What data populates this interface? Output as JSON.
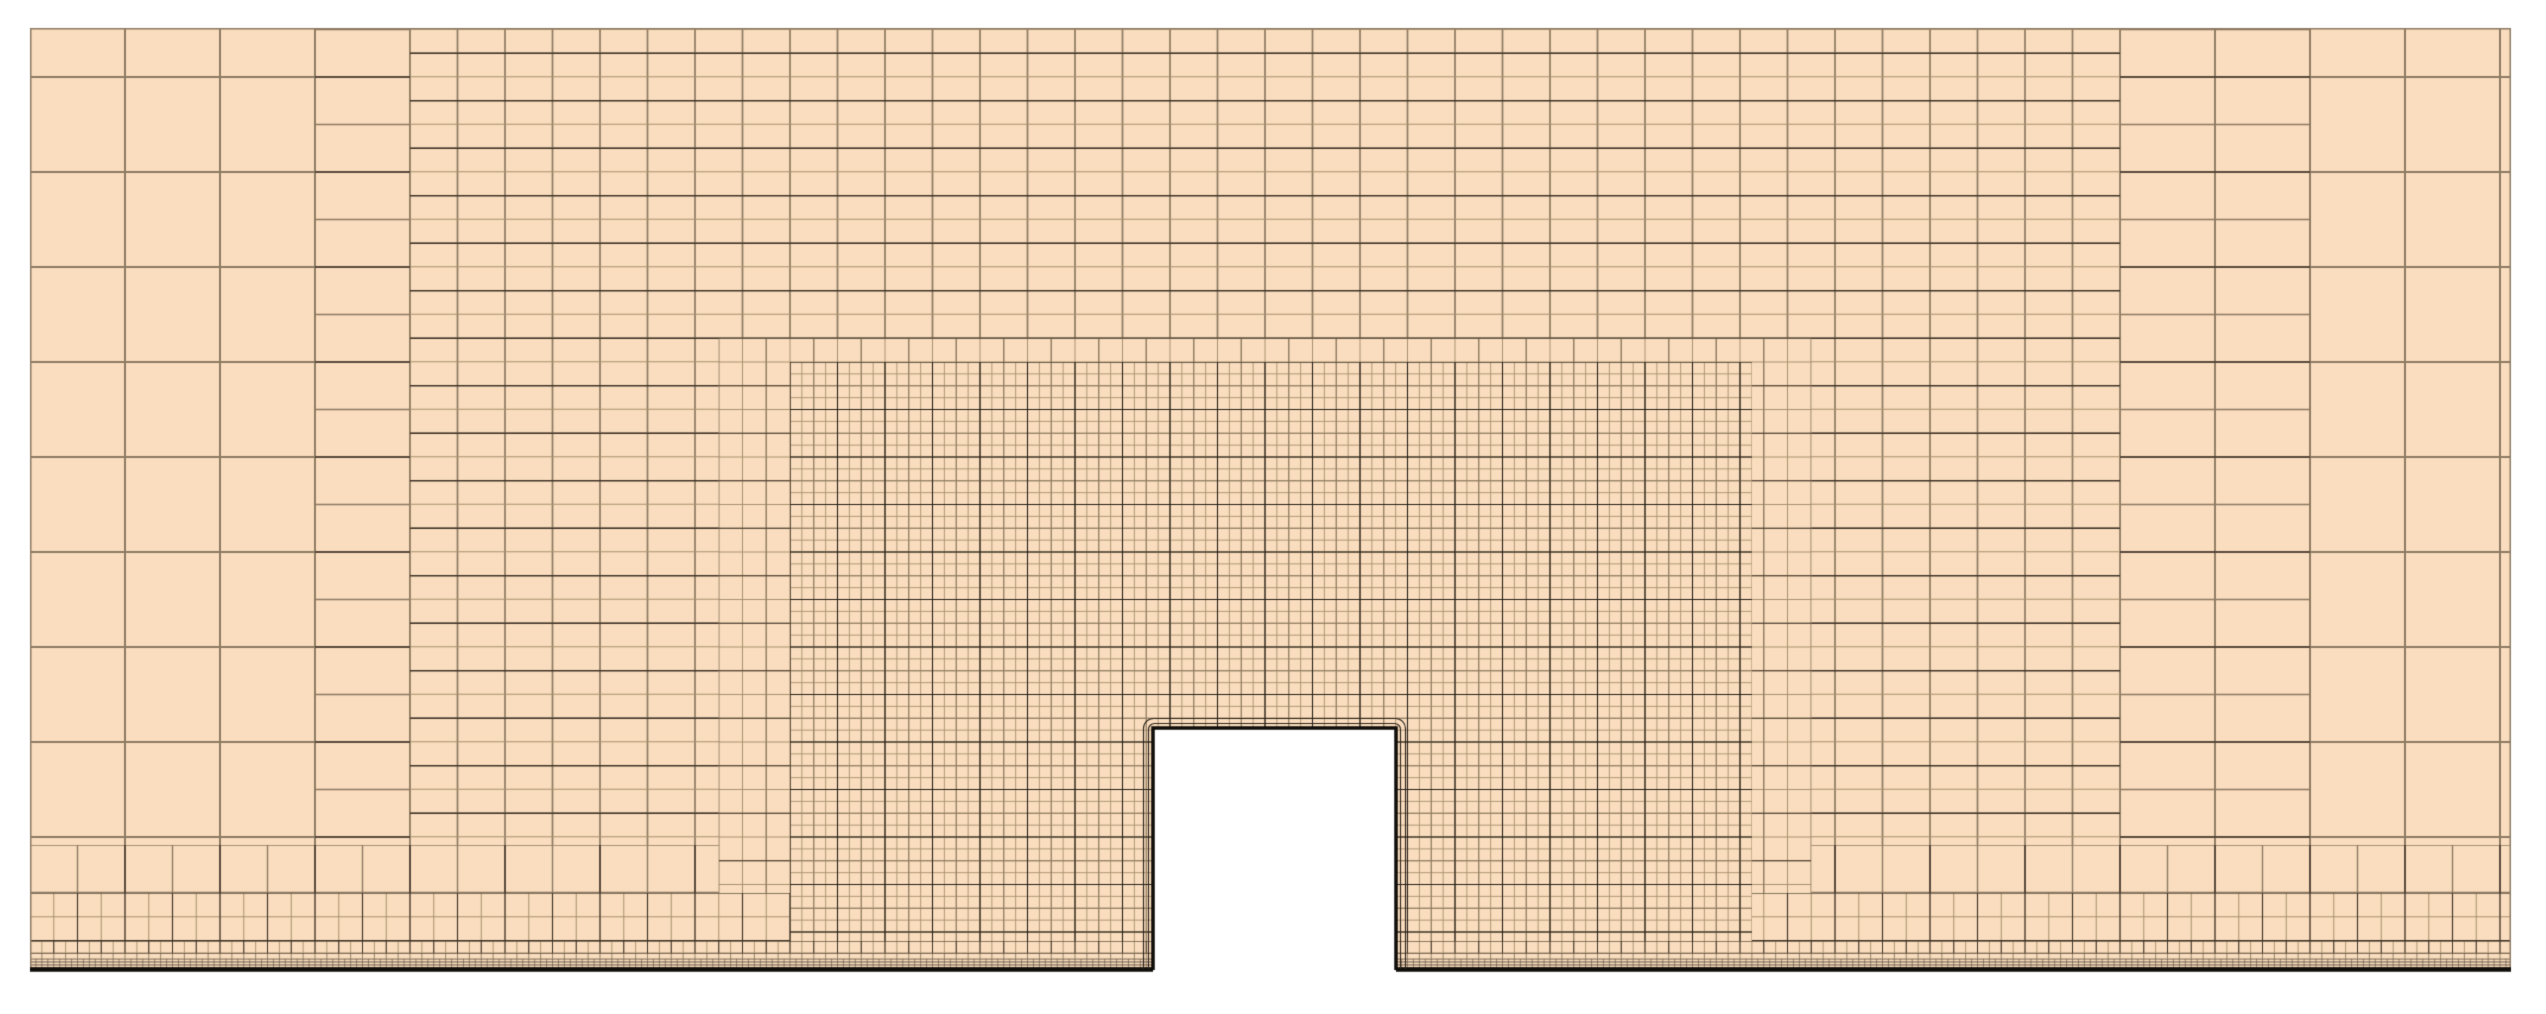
{
  "figure": {
    "type": "cfd-quadtree-mesh-section",
    "description": "2D computational mesh around a rectangular wall-mounted obstacle with nested refinement zones and near-ground boundary-layer strips",
    "width": 2546,
    "height": 1014
  },
  "colors": {
    "white": "#ffffff",
    "bg": "#f9ddbe",
    "light": "#a8916e",
    "med": "#8d7a62",
    "dark": "#3f3328",
    "darkest": "#272019",
    "ink": "#0f0c09",
    "ring": "#2d241b"
  },
  "mesh": {
    "domain": {
      "rect": [
        30,
        28,
        2481,
        942
      ]
    },
    "domain_border": {
      "rect": [
        30.75,
        28.75,
        2479.5,
        940.5
      ],
      "color": "med",
      "width": 1.5
    },
    "zones": [
      {
        "name": "background-level0",
        "rect": [
          30,
          28,
          2481,
          942
        ],
        "lattices": [
          {
            "axis": "v",
            "step": 95,
            "off": 0,
            "color": "med",
            "width": 2
          },
          {
            "axis": "h",
            "step": 95,
            "off": 49,
            "color": "med",
            "width": 2
          }
        ]
      },
      {
        "name": "transition-level1",
        "rect": [
          315,
          28,
          1995,
          942
        ],
        "lattices": [
          {
            "axis": "v",
            "step": 95,
            "off": 0,
            "color": "med",
            "width": 1.9
          },
          {
            "axis": "h",
            "step": 47.5,
            "off": 49,
            "color": "med",
            "width": 1.3
          },
          {
            "axis": "h",
            "step": 95,
            "off": 49,
            "color": "dark",
            "width": 1.5
          }
        ]
      },
      {
        "name": "band-level1-aniso",
        "rect": [
          410,
          28,
          1710,
          942
        ],
        "lattices": [
          {
            "axis": "v",
            "step": 47.5,
            "off": 0,
            "color": "med",
            "width": 1.7
          },
          {
            "axis": "h",
            "step": 23.75,
            "off": 1.25,
            "color": "light",
            "width": 1.1
          },
          {
            "axis": "h",
            "step": 47.5,
            "off": 25.25,
            "color": "dark",
            "width": 1.3
          }
        ]
      },
      {
        "name": "ground-strip-level1",
        "rect": [
          30,
          845,
          2481,
          125
        ],
        "lattices": [
          {
            "axis": "v",
            "step": 47.5,
            "off": 0,
            "color": "med",
            "width": 1.4
          },
          {
            "axis": "h",
            "step": 47.5,
            "off": 0,
            "color": "med",
            "width": 1.4
          },
          {
            "axis": "v",
            "step": 95,
            "off": 0,
            "color": "dark",
            "width": 1.5
          }
        ]
      },
      {
        "name": "box-level2",
        "rect": [
          718.75,
          338.25,
          1092.5,
          631.75
        ],
        "lattices": [
          {
            "axis": "v",
            "step": 23.75,
            "off": 0,
            "color": "light",
            "width": 1
          },
          {
            "axis": "h",
            "step": 23.75,
            "off": 0,
            "color": "light",
            "width": 1
          },
          {
            "axis": "v",
            "step": 47.5,
            "off": 0,
            "color": "med",
            "width": 1.2
          },
          {
            "axis": "h",
            "step": 47.5,
            "off": 0,
            "color": "dark",
            "width": 1.2
          }
        ]
      },
      {
        "name": "ground-strip-level2",
        "rect": [
          30,
          893,
          2481,
          77
        ],
        "lattices": [
          {
            "axis": "v",
            "step": 23.75,
            "off": 0,
            "color": "light",
            "width": 1
          },
          {
            "axis": "h",
            "step": 23.75,
            "off": 0,
            "color": "light",
            "width": 1
          },
          {
            "axis": "v",
            "step": 47.5,
            "off": 0,
            "color": "dark",
            "width": 1.15
          },
          {
            "axis": "h",
            "step": 47.5,
            "off": 0,
            "color": "dark",
            "width": 1.15
          }
        ]
      },
      {
        "name": "box-level3-dense",
        "rect": [
          790,
          362,
          961.9,
          608
        ],
        "lattices": [
          {
            "axis": "v",
            "step": 11.875,
            "off": 0,
            "color": "light",
            "width": 0.9
          },
          {
            "axis": "h",
            "step": 11.875,
            "off": 0,
            "color": "light",
            "width": 0.9
          },
          {
            "axis": "v",
            "step": 23.75,
            "off": 0,
            "color": "med",
            "width": 1
          },
          {
            "axis": "h",
            "step": 23.75,
            "off": 0,
            "color": "med",
            "width": 1
          },
          {
            "axis": "v",
            "step": 47.5,
            "off": 0,
            "color": "darkest",
            "width": 1.1
          },
          {
            "axis": "h",
            "step": 47.5,
            "off": 0,
            "color": "darkest",
            "width": 1.1
          }
        ]
      },
      {
        "name": "ground-strip-level3",
        "rect": [
          30,
          941,
          2481,
          29
        ],
        "lattices": [
          {
            "axis": "v",
            "step": 11.875,
            "off": 0,
            "color": "light",
            "width": 0.9
          },
          {
            "axis": "h",
            "step": 11.875,
            "off": 0,
            "color": "light",
            "width": 0.9
          },
          {
            "axis": "v",
            "step": 23.75,
            "off": 0,
            "color": "dark",
            "width": 1
          },
          {
            "axis": "h",
            "step": 23.75,
            "off": 0,
            "color": "dark",
            "width": 1
          }
        ]
      },
      {
        "name": "ground-strip-level4",
        "rect": [
          30,
          953,
          2481,
          17
        ],
        "lattices": [
          {
            "axis": "v",
            "step": 11.875,
            "off": 0,
            "color": "med",
            "width": 0.9
          },
          {
            "axis": "h",
            "step": 5.9375,
            "off": 0,
            "color": "med",
            "width": 0.9
          },
          {
            "axis": "h",
            "step": 11.875,
            "off": 0,
            "color": "dark",
            "width": 1
          }
        ]
      },
      {
        "name": "ground-strip-level5",
        "rect": [
          30,
          959,
          2481,
          11
        ],
        "lattices": [
          {
            "axis": "v",
            "step": 5.9375,
            "off": 0,
            "color": "med",
            "width": 0.8
          },
          {
            "axis": "h",
            "step": 2.96875,
            "off": 0,
            "color": "dark",
            "width": 0.8
          }
        ]
      }
    ],
    "ground_line": {
      "x1": 30,
      "x2": 2511,
      "y": 969.5,
      "width": 4.5,
      "color": "ink"
    },
    "obstacle": {
      "x": 1153,
      "y": 728,
      "w": 243,
      "wall_bottom": 970,
      "bottom": 1014,
      "border_width": 3.5,
      "border_color": "ink",
      "fill": "white",
      "ring_offsets": [
        4.5,
        9.5
      ],
      "ring_radii": [
        6,
        10
      ],
      "ring_width": 1.15,
      "ring_color": "ring"
    },
    "margins": [
      [
        0,
        0,
        2546,
        28
      ],
      [
        0,
        0,
        30,
        1014
      ],
      [
        2511,
        0,
        35,
        1014
      ],
      [
        0,
        972,
        2546,
        42
      ]
    ]
  }
}
